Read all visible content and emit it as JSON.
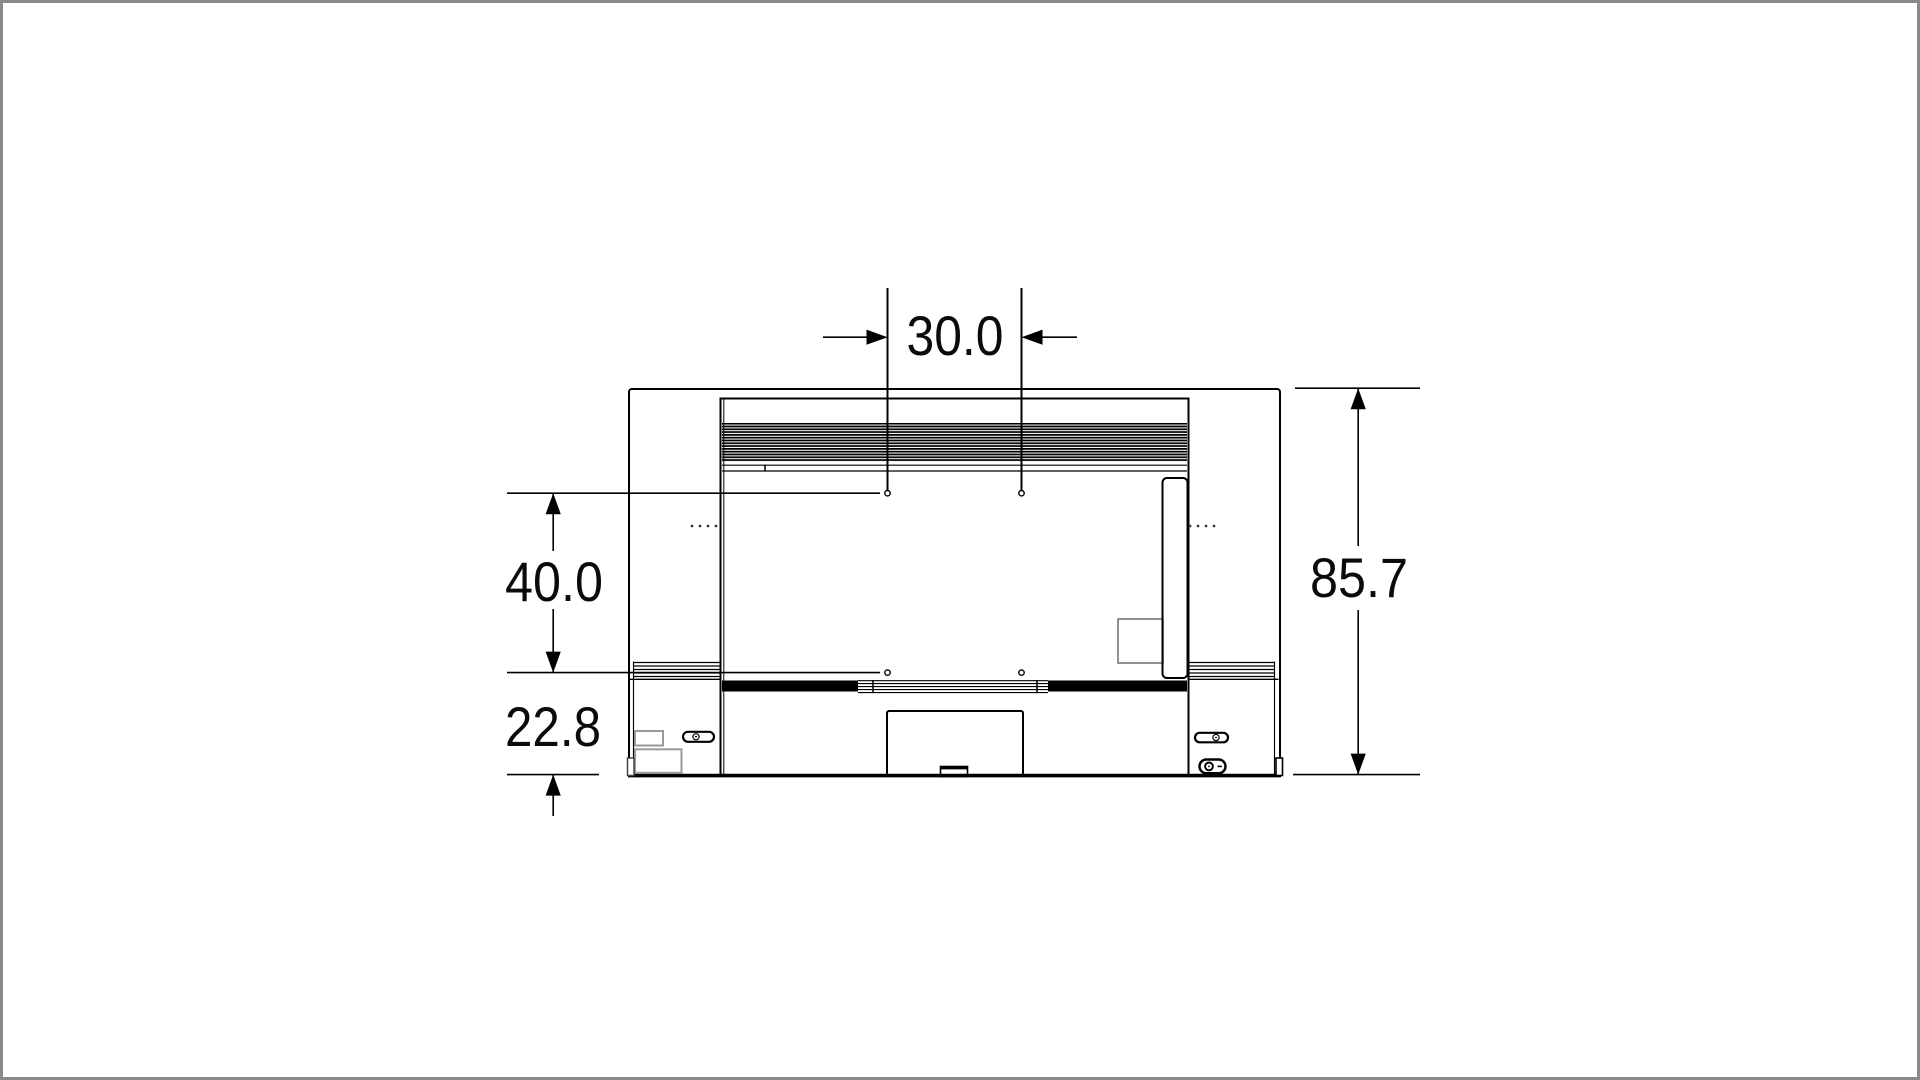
{
  "diagram": {
    "kind": "tv-rear-view-dimension-drawing",
    "labels": {
      "dim_width_between_holes": "30.0",
      "dim_height_between_holes": "40.0",
      "dim_holes_to_bottom": "22.8",
      "dim_overall_height": "85.7"
    },
    "colors": {
      "line": "#000000",
      "background": "#ffffff",
      "page_border": "#8a8a8a",
      "sticker_outline": "#999999"
    }
  }
}
